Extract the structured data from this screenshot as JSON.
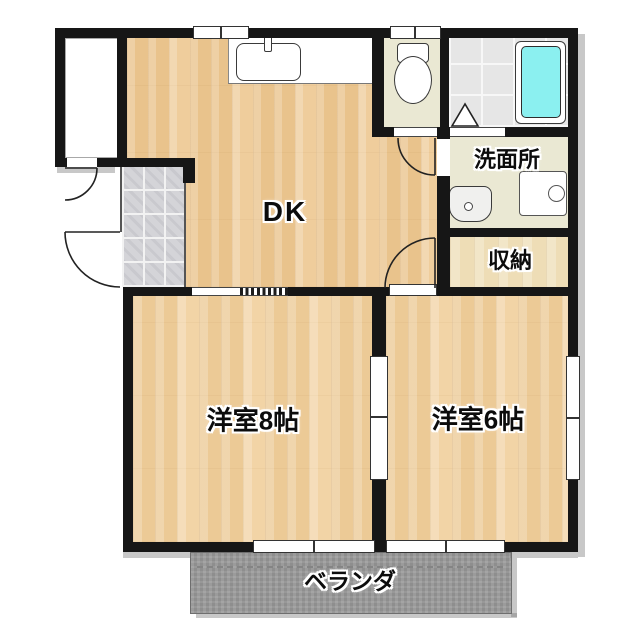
{
  "type": "floor-plan",
  "layout_name": "2DK apartment floor plan",
  "rooms": {
    "dk": {
      "label": "DK"
    },
    "washroom": {
      "label": "洗面所"
    },
    "storage": {
      "label": "収納"
    },
    "western_room_8": {
      "label": "洋室8帖"
    },
    "western_room_6": {
      "label": "洋室6帖"
    },
    "veranda": {
      "label": "ベランダ"
    }
  },
  "fixtures": {
    "kitchen_sink": "kitchen-sink",
    "toilet": "toilet",
    "bathtub": "bathtub",
    "wash_basin": "wash-basin",
    "washing_machine_pan": "washing-machine-pan"
  },
  "colors": {
    "wall": "#161616",
    "wood_floor": "#efcd9c",
    "room_floor": "#f2d4a6",
    "storage_floor": "#eeddb6",
    "sanitary_floor": "#eae8d3",
    "bath_tile": "#e6e6e6",
    "genkan_tile": "#d4d4d8",
    "bathtub_water": "#8bf0f0",
    "veranda": "#9c9c9c"
  }
}
